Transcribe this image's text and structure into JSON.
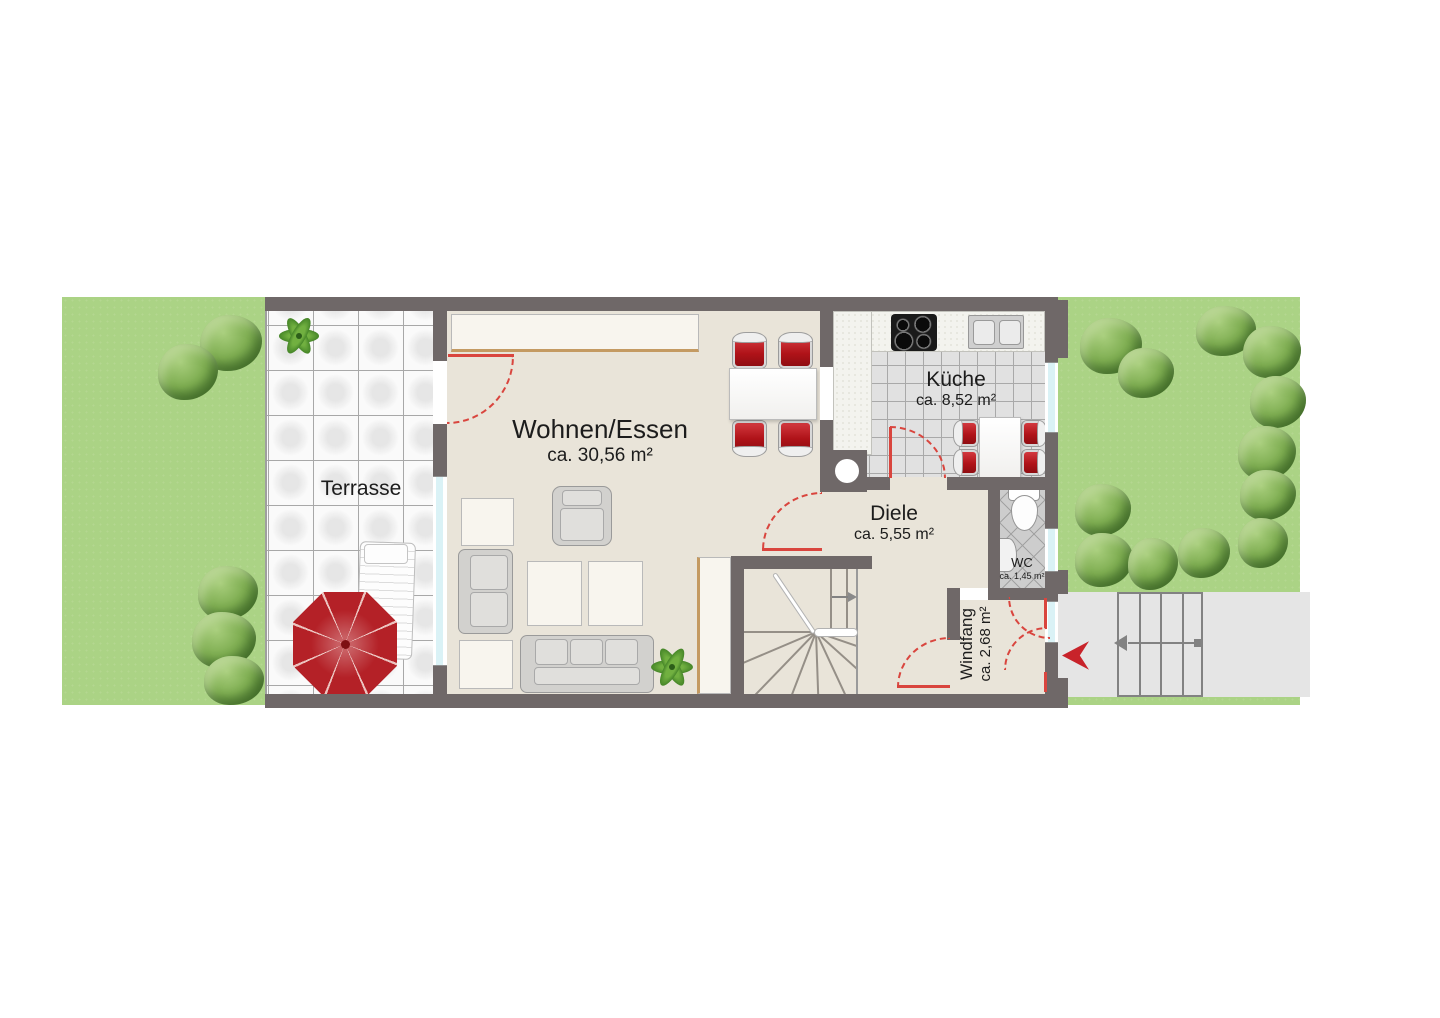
{
  "rooms": {
    "terrasse": {
      "label": "Terrasse"
    },
    "wohnen_essen": {
      "label": "Wohnen/Essen",
      "area": "ca. 30,56 m²"
    },
    "kueche": {
      "label": "Küche",
      "area": "ca. 8,52 m²"
    },
    "diele": {
      "label": "Diele",
      "area": "ca. 5,55 m²"
    },
    "wc": {
      "label": "WC",
      "area": "ca. 1,45 m²"
    },
    "windfang": {
      "label": "Windfang",
      "area": "ca. 2,68 m²"
    }
  },
  "icons": {
    "entry_arrow": "red arrow pointing left into entrance door",
    "stair_direction_arrow": "gray arrow showing stair direction",
    "outdoor_steps_arrow": "gray arrow on exterior steps pointing toward house",
    "plant": "green plant",
    "umbrella": "red parasol"
  },
  "colors": {
    "wall": "#6f6868",
    "interior_floor": "#e9e4d9",
    "lawn": "#abd385",
    "terrace_tile": "#fafafa",
    "kitchen_tile": "#e1e1e1",
    "paving": "#e5e5e5",
    "accent_red": "#c8232a",
    "door_swing_red": "#d9453e",
    "window_glass": "#daf2f6"
  }
}
